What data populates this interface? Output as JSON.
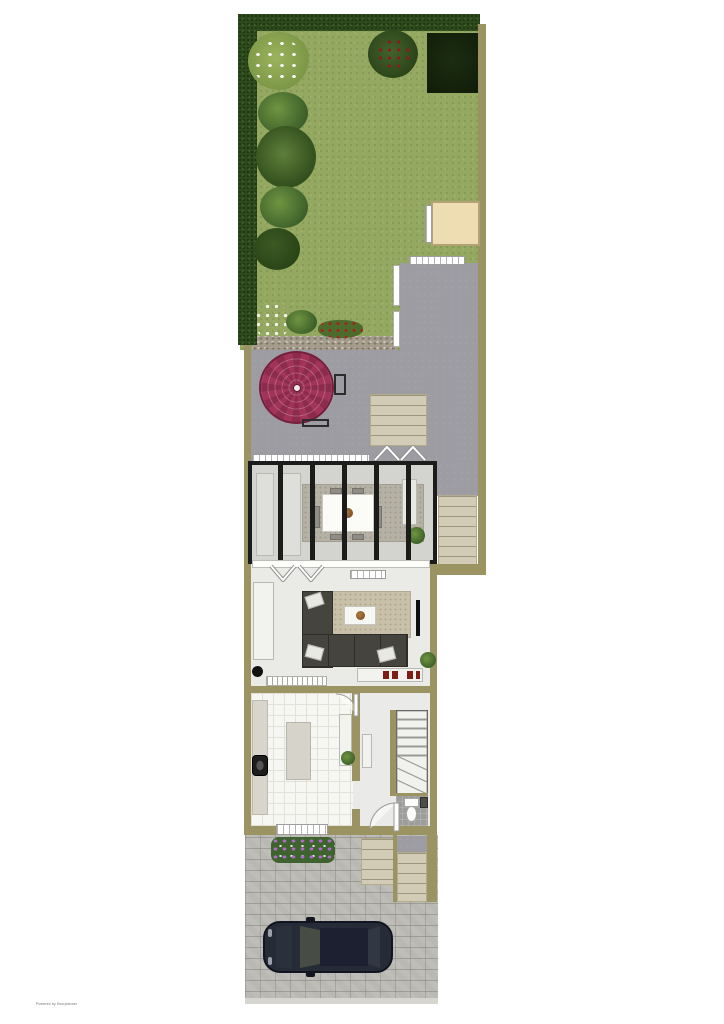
{
  "watermark": "Powered by floorplanner",
  "palette": {
    "grass": "#94a862",
    "hedge": "#2e4a1d",
    "pond": "#15230e",
    "boundary_wall": "#9b9462",
    "paving": "#9c9ca2",
    "gravel": "#a59c8d",
    "cobbles": "#b9b8b3",
    "shed": "#eedcb2",
    "parasol": "#9c3156",
    "conservatory_frame": "#1c1c1a",
    "living_floor": "#eaeae6",
    "kitchen_tile": "#f6f6f3",
    "sofa": "#45443f",
    "dining_rug": "#b5b1a4",
    "living_rug": "#c9c0a9",
    "steps": "#d2cbb6",
    "car": "#262b38",
    "plant": "#4e7a3a",
    "flower_bed_bloom": "#a86ec0"
  },
  "areas": {
    "garden": "garden",
    "terrace": "terrace",
    "side_path": "side-path",
    "conservatory": "conservatory-dining-room",
    "living": "living-room",
    "kitchen": "kitchen",
    "hallway": "hallway",
    "stairs": "staircase",
    "wc": "wc",
    "driveway": "driveway"
  },
  "objects": [
    "hedge",
    "pond",
    "garden-shed",
    "parasol",
    "dining-table",
    "sofa",
    "tv",
    "sideboard",
    "kitchen-island",
    "cooktop",
    "toilet",
    "car",
    "flower-bed"
  ]
}
